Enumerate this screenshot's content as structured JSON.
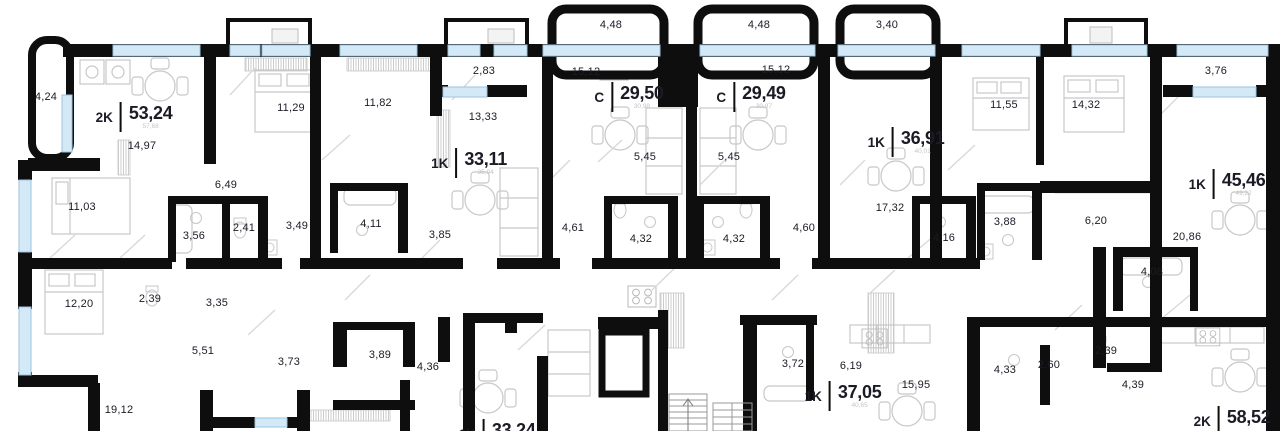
{
  "colors": {
    "wall": "#0e0e0e",
    "window": "#d4e9f8",
    "window_edge": "#9cc2db",
    "furniture": "#c7c7c7",
    "label": "#1b1b26",
    "label_faint": "#c4c4c4",
    "background": "#ffffff"
  },
  "apartments": [
    {
      "type": "2K",
      "area": "53,24",
      "total": "57,68"
    },
    {
      "type": "1K",
      "area": "33,11",
      "total": "35,94"
    },
    {
      "type": "C",
      "area": "29,50",
      "total": "30,98"
    },
    {
      "type": "C",
      "area": "29,49",
      "total": "30,97"
    },
    {
      "type": "1K",
      "area": "36,91",
      "total": "40,01"
    },
    {
      "type": "1K",
      "area": "45,46",
      "total": "49,22"
    },
    {
      "type": "1K",
      "area": "37,05",
      "total": "40,65"
    },
    {
      "type": "2K",
      "area": "58,52",
      "total": ""
    },
    {
      "type": "1K",
      "area": "33,24",
      "total": ""
    }
  ],
  "dims": [
    {
      "name": "balcony-left",
      "value": "4,24"
    },
    {
      "name": "kitchen-living-2k53",
      "value": "14,97"
    },
    {
      "name": "bedroom-2k53",
      "value": "11,03"
    },
    {
      "name": "hall-2k53",
      "value": "6,49"
    },
    {
      "name": "bath-2k53",
      "value": "3,56"
    },
    {
      "name": "wc-2k53",
      "value": "2,41"
    },
    {
      "name": "hall2-2k53",
      "value": "3,49"
    },
    {
      "name": "bedroom-11-29",
      "value": "11,29"
    },
    {
      "name": "bedroom-11-82",
      "value": "11,82"
    },
    {
      "name": "bath-1k33",
      "value": "4,11"
    },
    {
      "name": "loggia-1k33",
      "value": "2,83"
    },
    {
      "name": "kitchen-1k33",
      "value": "13,33"
    },
    {
      "name": "hall-1k33",
      "value": "3,85"
    },
    {
      "name": "living-s2950",
      "value": "15,12"
    },
    {
      "name": "kitchen-s2950",
      "value": "5,45"
    },
    {
      "name": "hall-s2950",
      "value": "4,61"
    },
    {
      "name": "bath-s2950",
      "value": "4,32"
    },
    {
      "name": "living-s2949",
      "value": "15,12"
    },
    {
      "name": "kitchen-s2949",
      "value": "5,45"
    },
    {
      "name": "bath-s2949",
      "value": "4,32"
    },
    {
      "name": "hall-s2949",
      "value": "4,60"
    },
    {
      "name": "balcony-top-1",
      "value": "4,48"
    },
    {
      "name": "balcony-top-2",
      "value": "4,48"
    },
    {
      "name": "balcony-top-3",
      "value": "3,40"
    },
    {
      "name": "living-1k36",
      "value": "17,32"
    },
    {
      "name": "hall-1k36",
      "value": "4,16"
    },
    {
      "name": "bedroom-11-55",
      "value": "11,55"
    },
    {
      "name": "bedroom-14-32",
      "value": "14,32"
    },
    {
      "name": "bath-3-88",
      "value": "3,88"
    },
    {
      "name": "hall-6-20",
      "value": "6,20"
    },
    {
      "name": "balcony-right",
      "value": "3,76"
    },
    {
      "name": "living-20-86",
      "value": "20,86"
    },
    {
      "name": "bath-4-08",
      "value": "4,08"
    },
    {
      "name": "bedroom-12-20",
      "value": "12,20"
    },
    {
      "name": "wc-2-39-left",
      "value": "2,39"
    },
    {
      "name": "hall-3-35",
      "value": "3,35"
    },
    {
      "name": "corridor-5-51",
      "value": "5,51"
    },
    {
      "name": "bath-3-73",
      "value": "3,73"
    },
    {
      "name": "bath-3-89",
      "value": "3,89"
    },
    {
      "name": "hall-4-36",
      "value": "4,36"
    },
    {
      "name": "living-19-12",
      "value": "19,12"
    },
    {
      "name": "bath-3-72",
      "value": "3,72"
    },
    {
      "name": "hall-6-19",
      "value": "6,19"
    },
    {
      "name": "kitchen-15-95",
      "value": "15,95"
    },
    {
      "name": "bath-4-33",
      "value": "4,33"
    },
    {
      "name": "hall-2-60",
      "value": "2,60"
    },
    {
      "name": "wc-2-39-right",
      "value": "2,39"
    },
    {
      "name": "hall-4-39",
      "value": "4,39"
    }
  ]
}
